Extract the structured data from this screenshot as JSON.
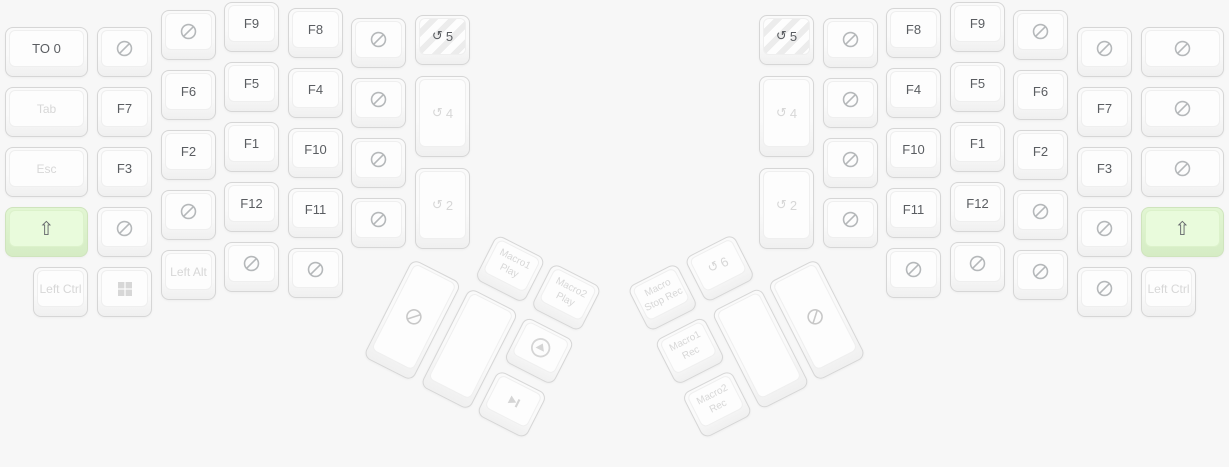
{
  "app": {
    "title": "ergodox-split-keyboard-layer-view"
  },
  "colors": {
    "page_bg": "#f7f7f7",
    "key_border": "#d6d6d6",
    "key_face": "#fdfdfd",
    "label_dark": "#5a5d61",
    "label_muted": "#d7d7d7",
    "nosign_gray": "#b5b8ba",
    "thumb_icon_gray": "#d5d5d5",
    "active_green_bg": "#e9fbdc",
    "active_green_border": "#cfe4bd",
    "hatch_stripe": "#ececec"
  },
  "glyphs": {
    "shift": "⇧",
    "layer": "↺"
  },
  "halves": {
    "left": {
      "main": [
        {
          "name": "key-to-layer-0",
          "x": 5,
          "y": 27,
          "w": 83,
          "h": 50,
          "label": "TO 0",
          "tone": "dark"
        },
        {
          "name": "key-tab",
          "x": 5,
          "y": 87,
          "w": 83,
          "h": 50,
          "label": "Tab",
          "tone": "lite",
          "small": true
        },
        {
          "name": "key-esc",
          "x": 5,
          "y": 147,
          "w": 83,
          "h": 50,
          "label": "Esc",
          "tone": "lite",
          "small": true
        },
        {
          "name": "key-shift-left",
          "x": 5,
          "y": 207,
          "w": 83,
          "h": 50,
          "icon": "shift",
          "green": true,
          "tone": "dark"
        },
        {
          "name": "key-left-ctrl",
          "x": 33,
          "y": 267,
          "w": 55,
          "h": 50,
          "label": "Left Ctrl",
          "tone": "lite",
          "small": true
        },
        {
          "name": "key-none",
          "x": 97,
          "y": 27,
          "w": 55,
          "h": 50,
          "icon": "nosign"
        },
        {
          "name": "key-f7",
          "x": 97,
          "y": 87,
          "w": 55,
          "h": 50,
          "label": "F7",
          "tone": "dark"
        },
        {
          "name": "key-f3",
          "x": 97,
          "y": 147,
          "w": 55,
          "h": 50,
          "label": "F3",
          "tone": "dark"
        },
        {
          "name": "key-none",
          "x": 97,
          "y": 207,
          "w": 55,
          "h": 50,
          "icon": "nosign"
        },
        {
          "name": "key-windows",
          "x": 97,
          "y": 267,
          "w": 55,
          "h": 50,
          "icon": "windows",
          "tone": "lite"
        },
        {
          "name": "key-none",
          "x": 161,
          "y": 10,
          "w": 55,
          "h": 50,
          "icon": "nosign"
        },
        {
          "name": "key-f6",
          "x": 161,
          "y": 70,
          "w": 55,
          "h": 50,
          "label": "F6",
          "tone": "dark"
        },
        {
          "name": "key-f2",
          "x": 161,
          "y": 130,
          "w": 55,
          "h": 50,
          "label": "F2",
          "tone": "dark"
        },
        {
          "name": "key-none",
          "x": 161,
          "y": 190,
          "w": 55,
          "h": 50,
          "icon": "nosign"
        },
        {
          "name": "key-left-alt",
          "x": 161,
          "y": 250,
          "w": 55,
          "h": 50,
          "label": "Left Alt",
          "tone": "lite",
          "small": true
        },
        {
          "name": "key-f9",
          "x": 224,
          "y": 2,
          "w": 55,
          "h": 50,
          "label": "F9",
          "tone": "dark"
        },
        {
          "name": "key-f5",
          "x": 224,
          "y": 62,
          "w": 55,
          "h": 50,
          "label": "F5",
          "tone": "dark"
        },
        {
          "name": "key-f1",
          "x": 224,
          "y": 122,
          "w": 55,
          "h": 50,
          "label": "F1",
          "tone": "dark"
        },
        {
          "name": "key-f12",
          "x": 224,
          "y": 182,
          "w": 55,
          "h": 50,
          "label": "F12",
          "tone": "dark"
        },
        {
          "name": "key-none",
          "x": 224,
          "y": 242,
          "w": 55,
          "h": 50,
          "icon": "nosign"
        },
        {
          "name": "key-f8",
          "x": 288,
          "y": 8,
          "w": 55,
          "h": 50,
          "label": "F8",
          "tone": "dark"
        },
        {
          "name": "key-f4",
          "x": 288,
          "y": 68,
          "w": 55,
          "h": 50,
          "label": "F4",
          "tone": "dark"
        },
        {
          "name": "key-f10",
          "x": 288,
          "y": 128,
          "w": 55,
          "h": 50,
          "label": "F10",
          "tone": "dark"
        },
        {
          "name": "key-f11",
          "x": 288,
          "y": 188,
          "w": 55,
          "h": 50,
          "label": "F11",
          "tone": "dark"
        },
        {
          "name": "key-none",
          "x": 288,
          "y": 248,
          "w": 55,
          "h": 50,
          "icon": "nosign"
        },
        {
          "name": "key-none",
          "x": 351,
          "y": 18,
          "w": 55,
          "h": 50,
          "icon": "nosign"
        },
        {
          "name": "key-none",
          "x": 351,
          "y": 78,
          "w": 55,
          "h": 50,
          "icon": "nosign"
        },
        {
          "name": "key-none",
          "x": 351,
          "y": 138,
          "w": 55,
          "h": 50,
          "icon": "nosign"
        },
        {
          "name": "key-none",
          "x": 351,
          "y": 198,
          "w": 55,
          "h": 50,
          "icon": "nosign"
        },
        {
          "name": "key-toggle-layer-5",
          "x": 415,
          "y": 15,
          "w": 55,
          "h": 50,
          "icon": "layer",
          "label": "5",
          "tone": "dark",
          "hatch": true
        },
        {
          "name": "key-toggle-layer-4",
          "x": 415,
          "y": 76,
          "w": 55,
          "h": 81,
          "icon": "layer",
          "label": "4",
          "tone": "lite"
        },
        {
          "name": "key-toggle-layer-2",
          "x": 415,
          "y": 168,
          "w": 55,
          "h": 81,
          "icon": "layer",
          "label": "2",
          "tone": "lite"
        }
      ],
      "thumb": {
        "origin_x": 440,
        "origin_y": 205,
        "rotation_deg": 27,
        "keys": [
          {
            "name": "key-macro1-play",
            "x": 64,
            "y": 0,
            "w": 55,
            "h": 50,
            "lines": [
              "Macro1",
              "Play"
            ],
            "tone": "lite"
          },
          {
            "name": "key-macro2-play",
            "x": 127,
            "y": 0,
            "w": 55,
            "h": 50,
            "lines": [
              "Macro2",
              "Play"
            ],
            "tone": "lite"
          },
          {
            "name": "key-none",
            "x": 0,
            "y": 60,
            "w": 55,
            "h": 110,
            "icon": "nosign",
            "icon_tone": "lite"
          },
          {
            "name": "key-blank",
            "x": 64,
            "y": 60,
            "w": 55,
            "h": 110
          },
          {
            "name": "key-arrow-up-circle",
            "x": 127,
            "y": 60,
            "w": 55,
            "h": 50,
            "icon": "arrow_up_circle",
            "tone": "lite"
          },
          {
            "name": "key-skip-next",
            "x": 127,
            "y": 120,
            "w": 55,
            "h": 50,
            "icon": "skip_next",
            "tone": "lite"
          }
        ]
      }
    },
    "right": {
      "main": [
        {
          "name": "key-toggle-layer-5",
          "x": 759,
          "y": 15,
          "w": 55,
          "h": 50,
          "icon": "layer",
          "label": "5",
          "tone": "dark",
          "hatch": true
        },
        {
          "name": "key-toggle-layer-4",
          "x": 759,
          "y": 76,
          "w": 55,
          "h": 81,
          "icon": "layer",
          "label": "4",
          "tone": "lite"
        },
        {
          "name": "key-toggle-layer-2",
          "x": 759,
          "y": 168,
          "w": 55,
          "h": 81,
          "icon": "layer",
          "label": "2",
          "tone": "lite"
        },
        {
          "name": "key-none",
          "x": 823,
          "y": 18,
          "w": 55,
          "h": 50,
          "icon": "nosign"
        },
        {
          "name": "key-none",
          "x": 823,
          "y": 78,
          "w": 55,
          "h": 50,
          "icon": "nosign"
        },
        {
          "name": "key-none",
          "x": 823,
          "y": 138,
          "w": 55,
          "h": 50,
          "icon": "nosign"
        },
        {
          "name": "key-none",
          "x": 823,
          "y": 198,
          "w": 55,
          "h": 50,
          "icon": "nosign"
        },
        {
          "name": "key-f8",
          "x": 886,
          "y": 8,
          "w": 55,
          "h": 50,
          "label": "F8",
          "tone": "dark"
        },
        {
          "name": "key-f4",
          "x": 886,
          "y": 68,
          "w": 55,
          "h": 50,
          "label": "F4",
          "tone": "dark"
        },
        {
          "name": "key-f10",
          "x": 886,
          "y": 128,
          "w": 55,
          "h": 50,
          "label": "F10",
          "tone": "dark"
        },
        {
          "name": "key-f11",
          "x": 886,
          "y": 188,
          "w": 55,
          "h": 50,
          "label": "F11",
          "tone": "dark"
        },
        {
          "name": "key-none",
          "x": 886,
          "y": 248,
          "w": 55,
          "h": 50,
          "icon": "nosign"
        },
        {
          "name": "key-f9",
          "x": 950,
          "y": 2,
          "w": 55,
          "h": 50,
          "label": "F9",
          "tone": "dark"
        },
        {
          "name": "key-f5",
          "x": 950,
          "y": 62,
          "w": 55,
          "h": 50,
          "label": "F5",
          "tone": "dark"
        },
        {
          "name": "key-f1",
          "x": 950,
          "y": 122,
          "w": 55,
          "h": 50,
          "label": "F1",
          "tone": "dark"
        },
        {
          "name": "key-f12",
          "x": 950,
          "y": 182,
          "w": 55,
          "h": 50,
          "label": "F12",
          "tone": "dark"
        },
        {
          "name": "key-none",
          "x": 950,
          "y": 242,
          "w": 55,
          "h": 50,
          "icon": "nosign"
        },
        {
          "name": "key-none",
          "x": 1013,
          "y": 10,
          "w": 55,
          "h": 50,
          "icon": "nosign"
        },
        {
          "name": "key-f6",
          "x": 1013,
          "y": 70,
          "w": 55,
          "h": 50,
          "label": "F6",
          "tone": "dark"
        },
        {
          "name": "key-f2",
          "x": 1013,
          "y": 130,
          "w": 55,
          "h": 50,
          "label": "F2",
          "tone": "dark"
        },
        {
          "name": "key-none",
          "x": 1013,
          "y": 190,
          "w": 55,
          "h": 50,
          "icon": "nosign"
        },
        {
          "name": "key-none",
          "x": 1013,
          "y": 250,
          "w": 55,
          "h": 50,
          "icon": "nosign"
        },
        {
          "name": "key-none",
          "x": 1077,
          "y": 27,
          "w": 55,
          "h": 50,
          "icon": "nosign"
        },
        {
          "name": "key-f7",
          "x": 1077,
          "y": 87,
          "w": 55,
          "h": 50,
          "label": "F7",
          "tone": "dark"
        },
        {
          "name": "key-f3",
          "x": 1077,
          "y": 147,
          "w": 55,
          "h": 50,
          "label": "F3",
          "tone": "dark"
        },
        {
          "name": "key-none",
          "x": 1077,
          "y": 207,
          "w": 55,
          "h": 50,
          "icon": "nosign"
        },
        {
          "name": "key-none",
          "x": 1077,
          "y": 267,
          "w": 55,
          "h": 50,
          "icon": "nosign"
        },
        {
          "name": "key-none",
          "x": 1141,
          "y": 27,
          "w": 83,
          "h": 50,
          "icon": "nosign"
        },
        {
          "name": "key-none",
          "x": 1141,
          "y": 87,
          "w": 83,
          "h": 50,
          "icon": "nosign"
        },
        {
          "name": "key-none",
          "x": 1141,
          "y": 147,
          "w": 83,
          "h": 50,
          "icon": "nosign"
        },
        {
          "name": "key-shift-right",
          "x": 1141,
          "y": 207,
          "w": 83,
          "h": 50,
          "icon": "shift",
          "green": true,
          "tone": "dark"
        },
        {
          "name": "key-left-ctrl",
          "x": 1141,
          "y": 267,
          "w": 55,
          "h": 50,
          "label": "Left Ctrl",
          "tone": "lite",
          "small": true
        }
      ],
      "thumb": {
        "origin_right_x": 789,
        "origin_y": 205,
        "rotation_deg": -27,
        "keys": [
          {
            "name": "key-macro-stop-rec",
            "x": 0,
            "y": 0,
            "w": 55,
            "h": 50,
            "lines": [
              "Macro",
              "Stop Rec"
            ],
            "tone": "lite"
          },
          {
            "name": "key-toggle-layer-6",
            "x": 64,
            "y": 0,
            "w": 55,
            "h": 50,
            "icon": "layer",
            "label": "6",
            "tone": "lite"
          },
          {
            "name": "key-macro1-rec",
            "x": 0,
            "y": 60,
            "w": 55,
            "h": 50,
            "lines": [
              "Macro1",
              "Rec"
            ],
            "tone": "lite"
          },
          {
            "name": "key-macro2-rec",
            "x": 0,
            "y": 120,
            "w": 55,
            "h": 50,
            "lines": [
              "Macro2",
              "Rec"
            ],
            "tone": "lite"
          },
          {
            "name": "key-blank",
            "x": 64,
            "y": 60,
            "w": 55,
            "h": 110
          },
          {
            "name": "key-none",
            "x": 127,
            "y": 60,
            "w": 55,
            "h": 110,
            "icon": "nosign",
            "icon_tone": "lite"
          }
        ]
      }
    }
  }
}
